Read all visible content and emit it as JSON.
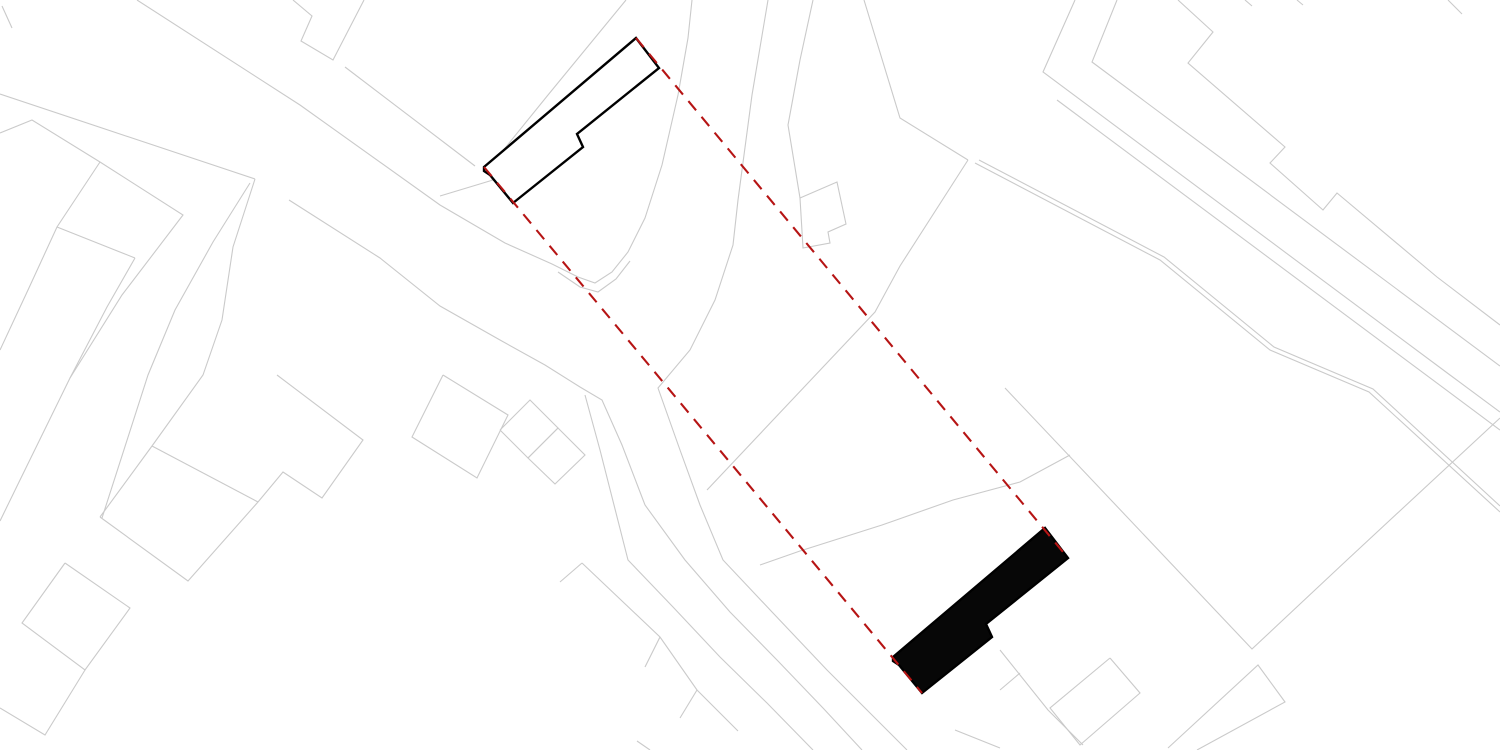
{
  "canvas": {
    "width": 1500,
    "height": 750,
    "background": "#ffffff"
  },
  "colors": {
    "parcel_line": "#cacaca",
    "building_outline": "#000000",
    "existing_building_fill": "#ffffff",
    "proposed_building_fill": "#070707",
    "guide_line": "#b61414"
  },
  "stroke_widths": {
    "parcel": 1.1,
    "building": 2.4,
    "guide": 2.1
  },
  "guide_dash_pattern": "12 8.5",
  "existing_building": {
    "points": [
      [
        484,
        167
      ],
      [
        636,
        38
      ],
      [
        659,
        68
      ],
      [
        577,
        134
      ],
      [
        583,
        147
      ],
      [
        513,
        203
      ],
      [
        490,
        175
      ],
      [
        484,
        171
      ]
    ]
  },
  "proposed_building": {
    "points": [
      [
        893,
        657
      ],
      [
        1045,
        528
      ],
      [
        1068,
        558
      ],
      [
        986,
        624
      ],
      [
        992,
        637
      ],
      [
        922,
        693
      ],
      [
        899,
        665
      ],
      [
        893,
        661
      ]
    ]
  },
  "guide_lines": [
    {
      "from": [
        636,
        38
      ],
      "to": [
        1068,
        558
      ]
    },
    {
      "from": [
        484,
        167
      ],
      "to": [
        922,
        693
      ]
    }
  ],
  "parcel_lines": [
    [
      [
        137,
        0
      ],
      [
        300,
        105
      ],
      [
        440,
        205
      ],
      [
        505,
        243
      ],
      [
        552,
        264
      ],
      [
        578,
        277
      ],
      [
        595,
        283
      ],
      [
        612,
        272
      ],
      [
        628,
        252
      ],
      [
        645,
        218
      ],
      [
        662,
        165
      ],
      [
        678,
        95
      ],
      [
        688,
        38
      ],
      [
        692,
        0
      ]
    ],
    [
      [
        558,
        272
      ],
      [
        580,
        287
      ],
      [
        598,
        292
      ],
      [
        616,
        279
      ],
      [
        630,
        261
      ]
    ],
    [
      [
        0,
        94
      ],
      [
        255,
        179
      ]
    ],
    [
      [
        255,
        179
      ],
      [
        233,
        247
      ],
      [
        222,
        320
      ],
      [
        203,
        375
      ],
      [
        152,
        446
      ],
      [
        100,
        517
      ]
    ],
    [
      [
        250,
        183
      ],
      [
        213,
        242
      ],
      [
        175,
        310
      ],
      [
        148,
        375
      ],
      [
        102,
        518
      ]
    ],
    [
      [
        0,
        133
      ],
      [
        32,
        120
      ],
      [
        100,
        162
      ],
      [
        183,
        215
      ],
      [
        122,
        295
      ],
      [
        70,
        378
      ],
      [
        20,
        480
      ],
      [
        0,
        521
      ]
    ],
    [
      [
        100,
        162
      ],
      [
        57,
        227
      ],
      [
        28,
        290
      ],
      [
        0,
        350
      ]
    ],
    [
      [
        135,
        258
      ],
      [
        57,
        227
      ]
    ],
    [
      [
        135,
        258
      ],
      [
        107,
        307
      ],
      [
        70,
        378
      ]
    ],
    [
      [
        2,
        6
      ],
      [
        12,
        28
      ]
    ],
    [
      [
        293,
        0
      ],
      [
        312,
        16
      ],
      [
        301,
        41
      ],
      [
        333,
        60
      ],
      [
        364,
        0
      ]
    ],
    [
      [
        152,
        446
      ],
      [
        258,
        502
      ]
    ],
    [
      [
        277,
        375
      ],
      [
        363,
        440
      ],
      [
        322,
        498
      ],
      [
        283,
        472
      ],
      [
        258,
        502
      ],
      [
        188,
        581
      ],
      [
        100,
        517
      ]
    ],
    [
      [
        65,
        563
      ],
      [
        130,
        608
      ],
      [
        85,
        670
      ],
      [
        22,
        623
      ],
      [
        65,
        563
      ]
    ],
    [
      [
        85,
        670
      ],
      [
        45,
        735
      ],
      [
        0,
        708
      ]
    ],
    [
      [
        443,
        375
      ],
      [
        412,
        437
      ],
      [
        477,
        478
      ],
      [
        508,
        415
      ],
      [
        443,
        375
      ]
    ],
    [
      [
        500,
        430
      ],
      [
        530,
        400
      ],
      [
        558,
        428
      ],
      [
        528,
        458
      ],
      [
        500,
        430
      ]
    ],
    [
      [
        528,
        458
      ],
      [
        558,
        428
      ],
      [
        585,
        455
      ],
      [
        555,
        484
      ],
      [
        528,
        458
      ]
    ],
    [
      [
        626,
        0
      ],
      [
        548,
        95
      ],
      [
        497,
        158
      ],
      [
        492,
        180
      ]
    ],
    [
      [
        345,
        67
      ],
      [
        475,
        166
      ]
    ],
    [
      [
        440,
        196
      ],
      [
        493,
        180
      ]
    ],
    [
      [
        289,
        200
      ],
      [
        380,
        258
      ],
      [
        440,
        306
      ],
      [
        500,
        340
      ],
      [
        545,
        365
      ],
      [
        580,
        387
      ],
      [
        602,
        400
      ],
      [
        622,
        445
      ],
      [
        645,
        505
      ],
      [
        685,
        560
      ],
      [
        730,
        612
      ],
      [
        777,
        660
      ],
      [
        823,
        708
      ],
      [
        862,
        750
      ]
    ],
    [
      [
        585,
        395
      ],
      [
        600,
        450
      ],
      [
        614,
        505
      ],
      [
        628,
        560
      ],
      [
        673,
        607
      ],
      [
        720,
        657
      ],
      [
        767,
        703
      ],
      [
        813,
        750
      ]
    ],
    [
      [
        768,
        0
      ],
      [
        752,
        95
      ],
      [
        738,
        200
      ],
      [
        733,
        245
      ],
      [
        715,
        300
      ],
      [
        690,
        350
      ],
      [
        658,
        388
      ],
      [
        680,
        450
      ],
      [
        700,
        505
      ],
      [
        723,
        560
      ],
      [
        773,
        613
      ],
      [
        827,
        670
      ],
      [
        880,
        723
      ],
      [
        907,
        750
      ]
    ],
    [
      [
        560,
        582
      ],
      [
        582,
        563
      ]
    ],
    [
      [
        582,
        563
      ],
      [
        660,
        637
      ],
      [
        697,
        690
      ],
      [
        738,
        731
      ]
    ],
    [
      [
        660,
        637
      ],
      [
        645,
        667
      ]
    ],
    [
      [
        697,
        690
      ],
      [
        680,
        718
      ]
    ],
    [
      [
        637,
        741
      ],
      [
        650,
        750
      ]
    ],
    [
      [
        813,
        0
      ],
      [
        800,
        60
      ],
      [
        788,
        125
      ],
      [
        800,
        198
      ]
    ],
    [
      [
        800,
        198
      ],
      [
        837,
        182
      ],
      [
        846,
        224
      ],
      [
        828,
        232
      ],
      [
        830,
        243
      ],
      [
        803,
        248
      ],
      [
        800,
        198
      ]
    ],
    [
      [
        864,
        0
      ],
      [
        900,
        118
      ],
      [
        968,
        160
      ]
    ],
    [
      [
        968,
        160
      ],
      [
        900,
        266
      ],
      [
        875,
        312
      ],
      [
        707,
        490
      ]
    ],
    [
      [
        760,
        565
      ],
      [
        800,
        551
      ],
      [
        882,
        525
      ],
      [
        953,
        500
      ],
      [
        1020,
        482
      ],
      [
        1070,
        455
      ]
    ],
    [
      [
        1075,
        0
      ],
      [
        1043,
        72
      ],
      [
        1450,
        375
      ],
      [
        1500,
        412
      ]
    ],
    [
      [
        1057,
        100
      ],
      [
        1500,
        430
      ]
    ],
    [
      [
        975,
        163
      ],
      [
        1160,
        260
      ],
      [
        1270,
        350
      ],
      [
        1369,
        392
      ],
      [
        1500,
        512
      ]
    ],
    [
      [
        979,
        160
      ],
      [
        1164,
        257
      ],
      [
        1274,
        347
      ],
      [
        1373,
        389
      ],
      [
        1500,
        506
      ]
    ],
    [
      [
        1117,
        0
      ],
      [
        1092,
        62
      ],
      [
        1500,
        366
      ]
    ],
    [
      [
        1178,
        0
      ],
      [
        1213,
        32
      ],
      [
        1188,
        63
      ],
      [
        1285,
        147
      ],
      [
        1270,
        163
      ],
      [
        1323,
        210
      ],
      [
        1337,
        193
      ],
      [
        1437,
        277
      ],
      [
        1500,
        325
      ]
    ],
    [
      [
        1245,
        0
      ],
      [
        1252,
        6
      ]
    ],
    [
      [
        1297,
        0
      ],
      [
        1303,
        5
      ]
    ],
    [
      [
        1448,
        0
      ],
      [
        1462,
        14
      ]
    ],
    [
      [
        1005,
        388
      ],
      [
        1252,
        649
      ],
      [
        1347,
        560
      ],
      [
        1500,
        418
      ]
    ],
    [
      [
        1168,
        748
      ],
      [
        1258,
        665
      ],
      [
        1285,
        702
      ],
      [
        1197,
        750
      ]
    ],
    [
      [
        1110,
        658
      ],
      [
        1140,
        693
      ],
      [
        1080,
        745
      ],
      [
        1050,
        708
      ],
      [
        1110,
        658
      ]
    ],
    [
      [
        1000,
        650
      ],
      [
        1048,
        710
      ],
      [
        1083,
        745
      ]
    ],
    [
      [
        1000,
        690
      ],
      [
        1020,
        673
      ]
    ],
    [
      [
        955,
        730
      ],
      [
        1000,
        748
      ]
    ]
  ]
}
